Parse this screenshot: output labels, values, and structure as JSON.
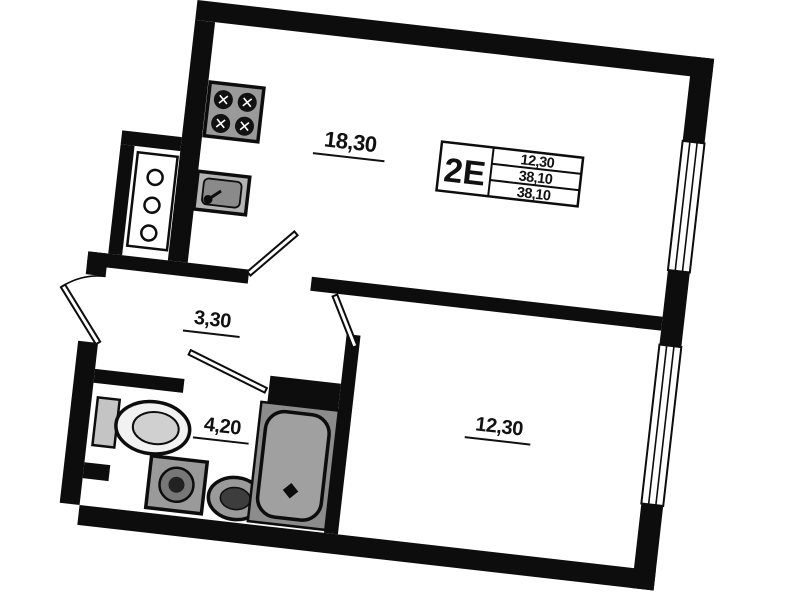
{
  "unit_info": {
    "type": "2E",
    "areas": [
      "12,30",
      "38,10",
      "38,10"
    ]
  },
  "room_labels": {
    "living_kitchen": "18,30",
    "hallway": "3,30",
    "bathroom": "4,20",
    "bedroom": "12,30"
  },
  "symbols": [
    "stove-symbol",
    "kitchen-sink-symbol",
    "vent-shaft-symbol",
    "toilet-symbol",
    "washing-machine-symbol",
    "bathroom-sink-symbol",
    "bathtub-symbol",
    "entrance-door-symbol",
    "window-symbol"
  ],
  "colors": {
    "wall": "#0d0d0d",
    "background": "#ffffff",
    "fixture_gray": "#9a9a9a",
    "tub_gray": "#a0a0a0"
  }
}
